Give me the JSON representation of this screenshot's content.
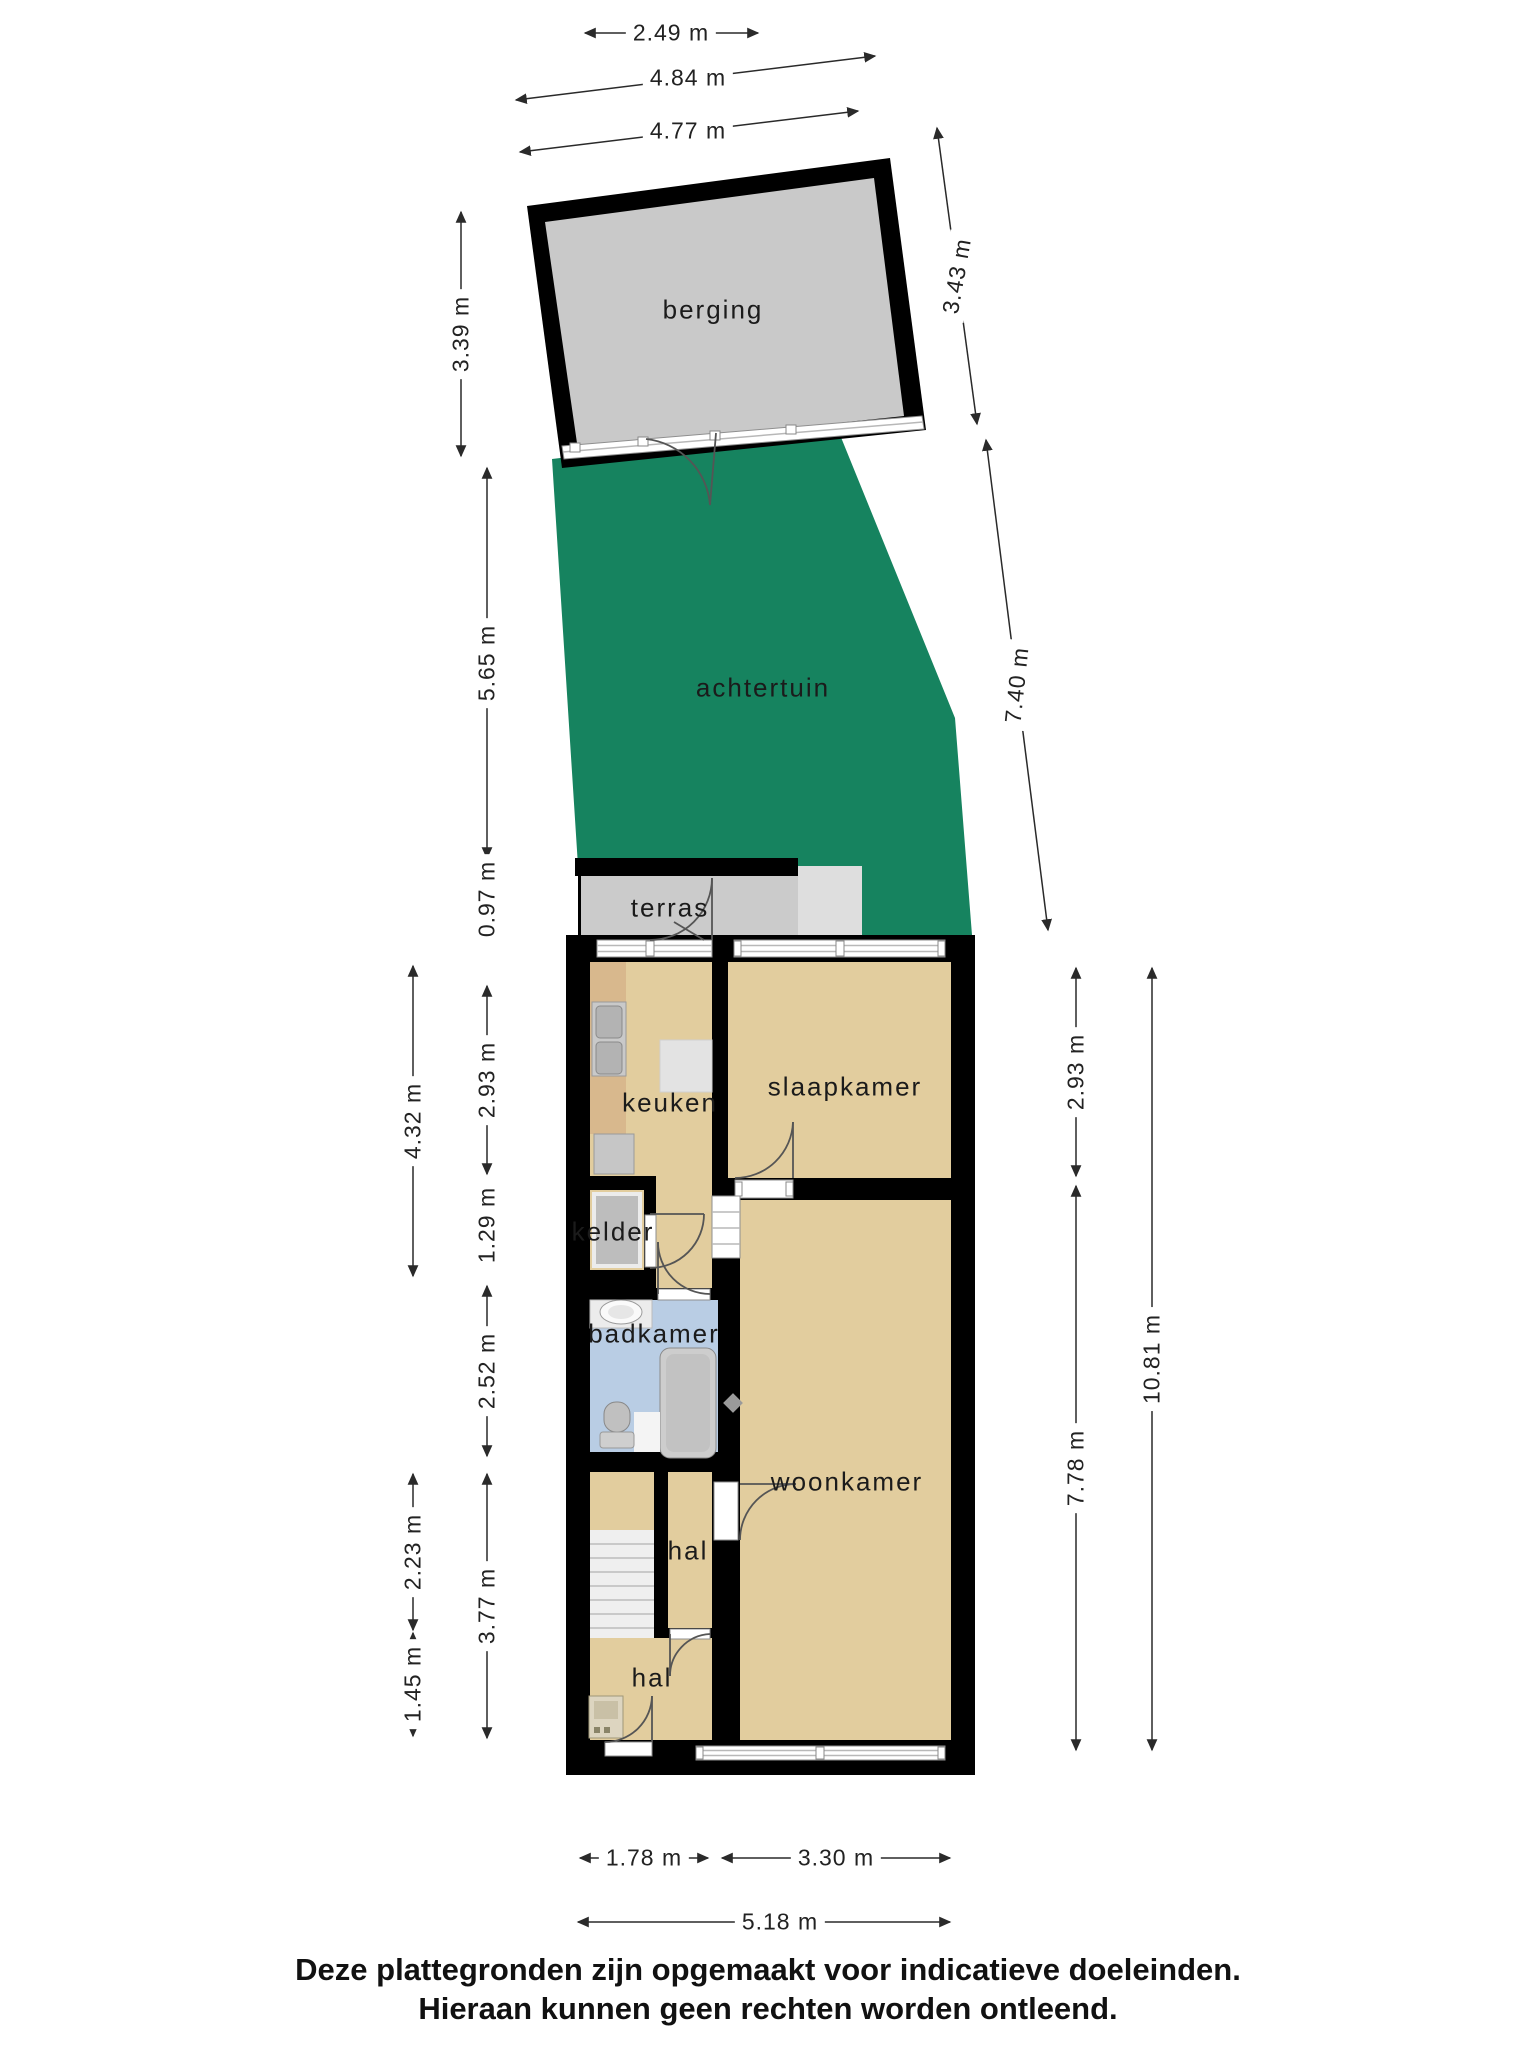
{
  "rooms": {
    "berging": "berging",
    "achtertuin": "achtertuin",
    "terras": "terras",
    "keuken": "keuken",
    "slaapkamer": "slaapkamer",
    "kelder": "kelder",
    "badkamer": "badkamer",
    "woonkamer": "woonkamer",
    "hal_upper": "hal",
    "hal_lower": "hal"
  },
  "dims": {
    "d249": "2.49 m",
    "d484": "4.84 m",
    "d477": "4.77 m",
    "d339": "3.39 m",
    "d565": "5.65 m",
    "d097": "0.97 m",
    "d293l": "2.93 m",
    "d129": "1.29 m",
    "d252": "2.52 m",
    "d377": "3.77 m",
    "d432": "4.32 m",
    "d223": "2.23 m",
    "d145": "1.45 m",
    "d343": "3.43 m",
    "d740": "7.40 m",
    "d293r": "2.93 m",
    "d778": "7.78 m",
    "d1081": "10.81 m",
    "d178": "1.78 m",
    "d330": "3.30 m",
    "d518": "5.18 m"
  },
  "disclaimer": {
    "line1": "Deze plattegronden zijn opgemaakt voor indicatieve doeleinden.",
    "line2": "Hieraan kunnen geen rechten worden ontleend."
  },
  "colors": {
    "garden": "#16835f",
    "room": "#e2cd9e",
    "bath": "#b9cde4",
    "terras": "#cbcbcb",
    "berging": "#c9c9c9",
    "wall": "#000000",
    "counter": "#d8b88d",
    "dimline": "#2a2a2a"
  }
}
